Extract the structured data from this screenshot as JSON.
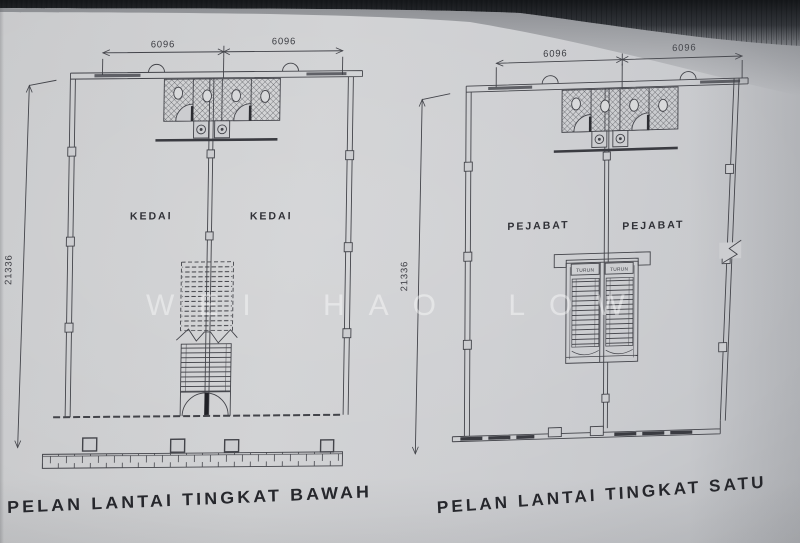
{
  "page": {
    "watermark": "WEI HAO LOW"
  },
  "colors": {
    "paper": "#cbccce",
    "ink": "#43444a",
    "scan_shadow": "#1b1d20"
  },
  "left_plan": {
    "title": "PELAN LANTAI TINGKAT BAWAH",
    "dim_top_left": "6096",
    "dim_top_right": "6096",
    "dim_side": "21336",
    "room_left": "KEDAI",
    "room_right": "KEDAI"
  },
  "right_plan": {
    "title": "PELAN LANTAI TINGKAT SATU",
    "dim_top_left": "6096",
    "dim_top_right": "6096",
    "dim_side": "21336",
    "room_left": "PEJABAT",
    "room_right": "PEJABAT",
    "stair_label_left": "TURUN",
    "stair_label_right": "TURUN"
  }
}
